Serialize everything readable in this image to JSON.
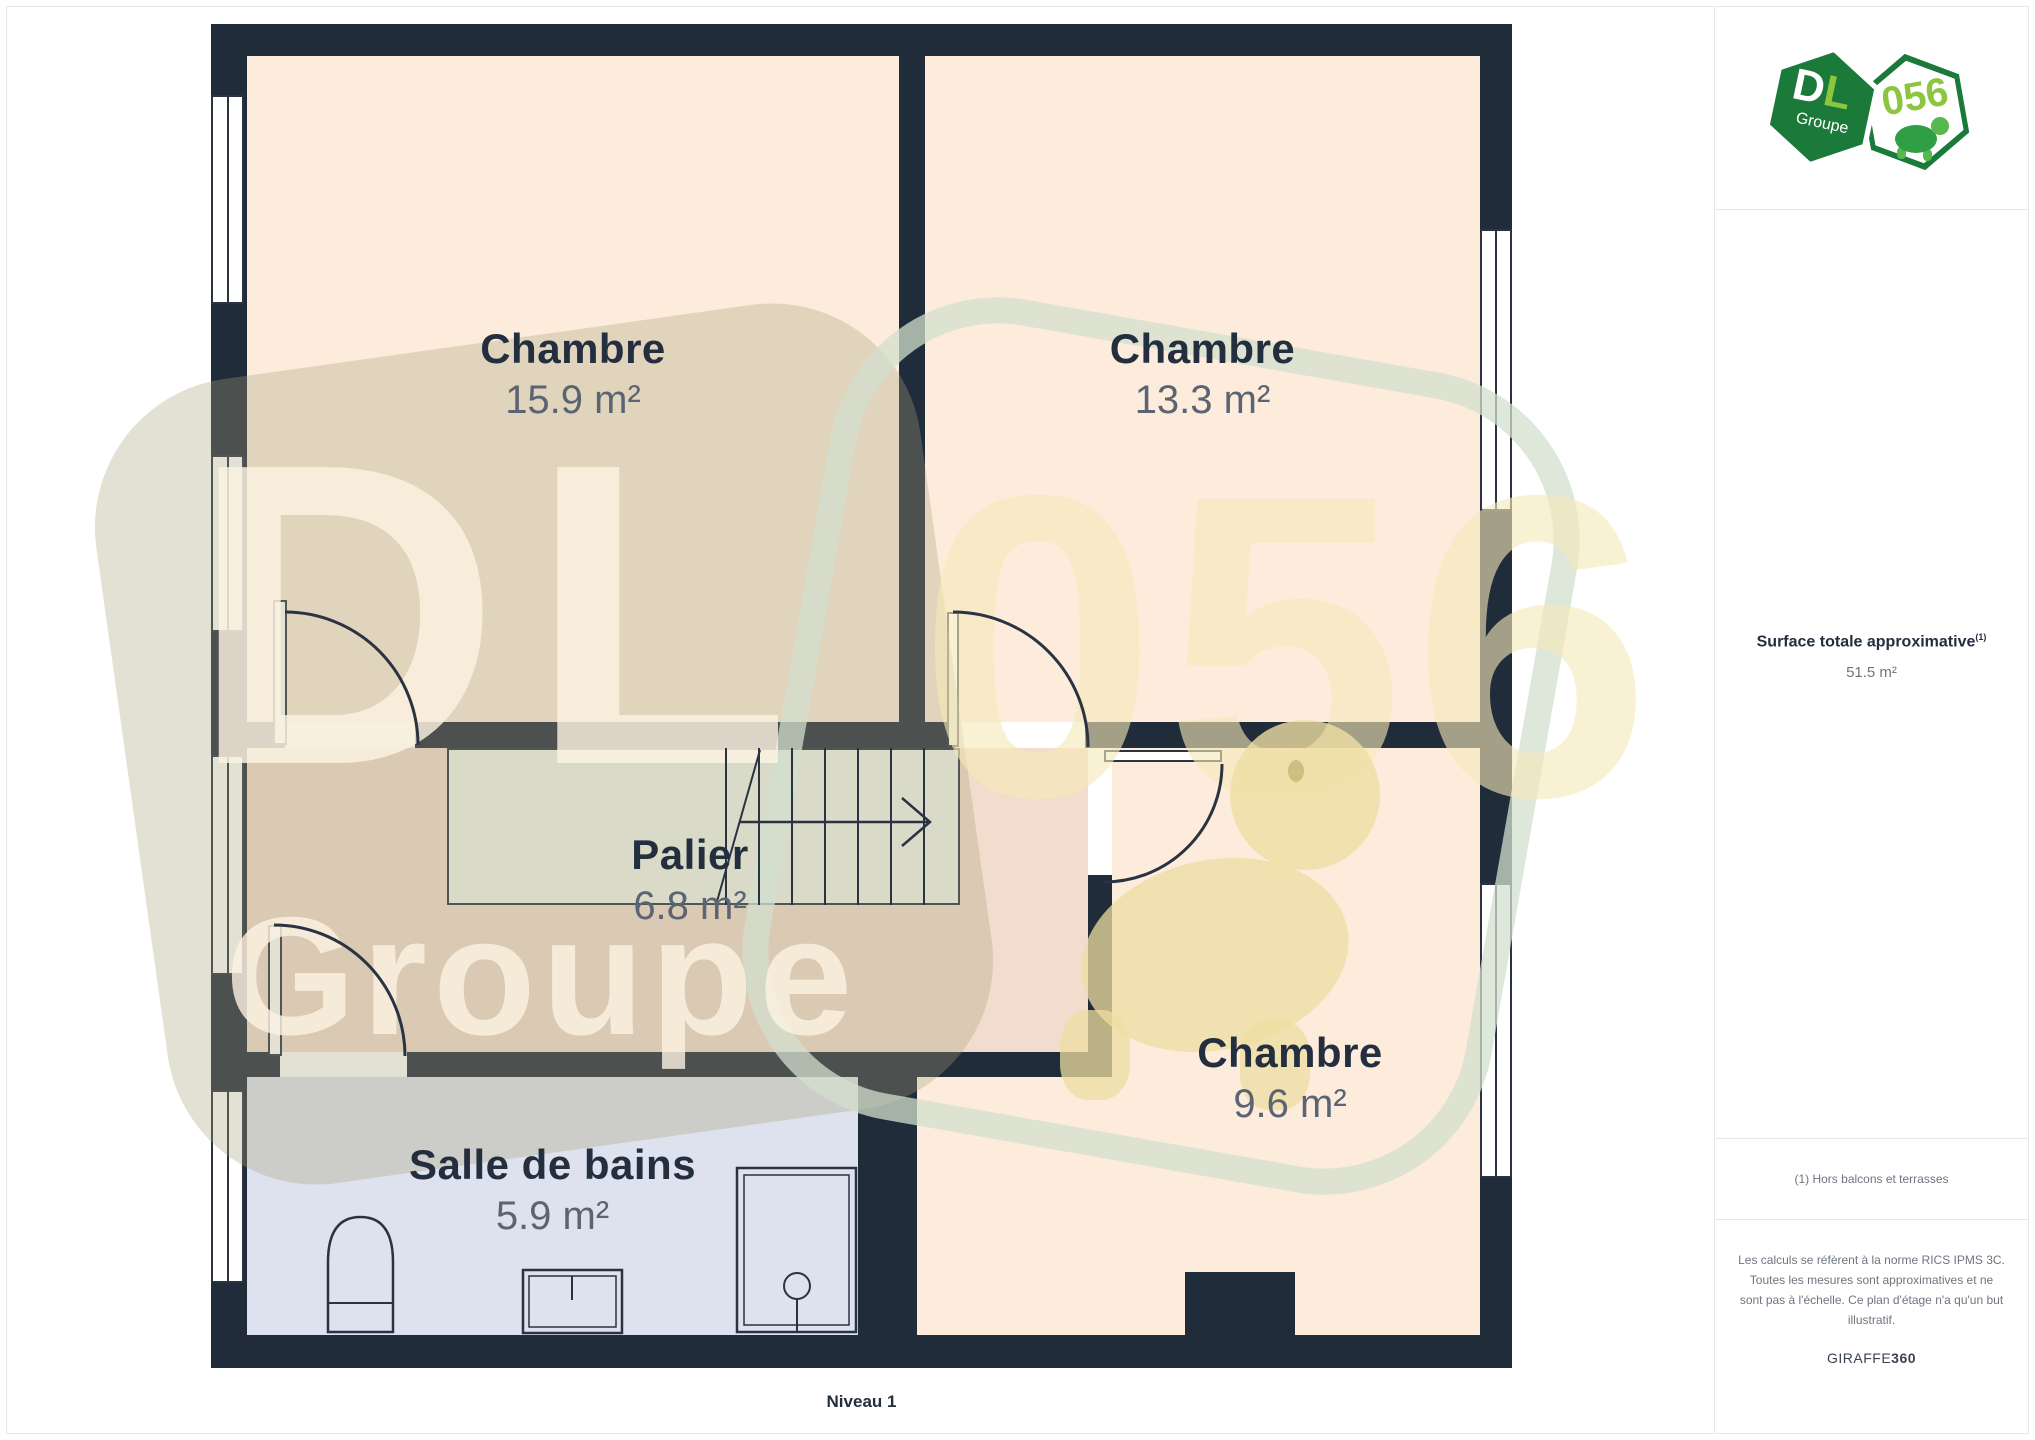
{
  "theme": {
    "wall": "#212C3B",
    "line": "#2A3342",
    "room": "#FDECDC",
    "palier": "#F2DCCE",
    "bath": "#DDE2EE",
    "stair": "#F2F5EF",
    "name": "#232E3E",
    "area": "#5A6472",
    "green": "#1B7A3A",
    "lime": "#8CC63F",
    "graytext": "#6E7580",
    "divider": "#E8E8E8"
  },
  "plan": {
    "level_label": "Niveau 1",
    "rooms": {
      "chambre1": {
        "name": "Chambre",
        "area": "15.9 m²"
      },
      "chambre2": {
        "name": "Chambre",
        "area": "13.3 m²"
      },
      "palier": {
        "name": "Palier",
        "area": "6.8 m²"
      },
      "salle_de_bains": {
        "name": "Salle de bains",
        "area": "5.9 m²"
      },
      "chambre3": {
        "name": "Chambre",
        "area": "9.6 m²"
      }
    }
  },
  "watermark": {
    "dl": "DL",
    "groupe": "Groupe",
    "code": "056"
  },
  "sidebar": {
    "logo": {
      "d": "D",
      "l": "L",
      "groupe": "Groupe",
      "code": "056"
    },
    "surface_title": "Surface totale approximative",
    "surface_sup": "(1)",
    "surface_value": "51.5 m²",
    "footnote": "(1) Hors balcons et terrasses",
    "disclaimer": "Les calculs se réfèrent à la norme RICS IPMS 3C. Toutes les mesures sont approximatives et ne sont pas à l'échelle. Ce plan d'étage n'a qu'un but illustratif.",
    "brand": {
      "giraffe": "GIRAFFE",
      "n360": "360"
    }
  }
}
